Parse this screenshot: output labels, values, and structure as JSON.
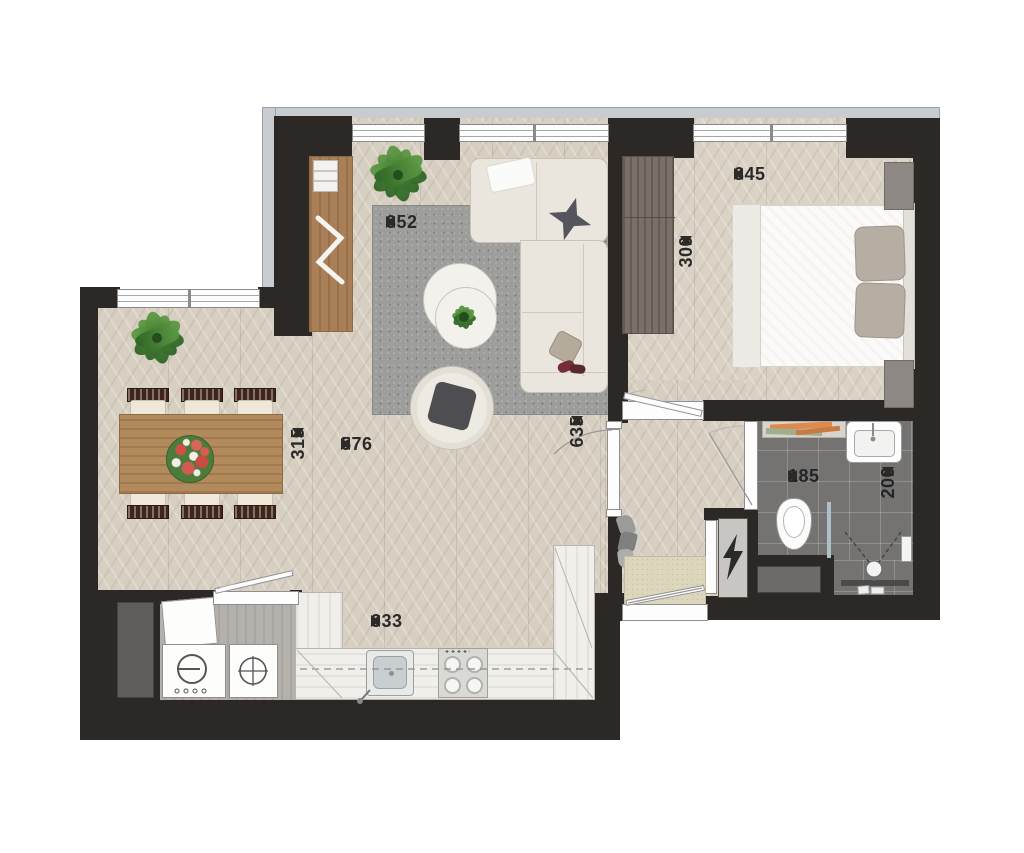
{
  "title": "apartment-floor-plan",
  "dimensions": {
    "living_rug_width": "352",
    "bedroom_width": "345",
    "bedroom_depth": "300",
    "open_area_width": "576",
    "open_area_depth": "635",
    "dining_depth": "315",
    "kitchen_width": "333",
    "bathroom_width": "185",
    "bathroom_depth": "200"
  },
  "colors": {
    "wall": "#2b2826",
    "floor": "#d7cfc2",
    "bathroom_tile": "#757372",
    "balcony_edge": "#c6ccd0",
    "rug": "#9d9d9c",
    "wood": "#b28a5c",
    "plant_green": "#4c7c3a"
  },
  "icons": {
    "electric_meter": "lightning-bolt-icon",
    "washer": "washing-machine-icon",
    "dryer": "dryer-icon",
    "stove": "four-burner-stove-icon",
    "shower": "shower-head-icon"
  }
}
